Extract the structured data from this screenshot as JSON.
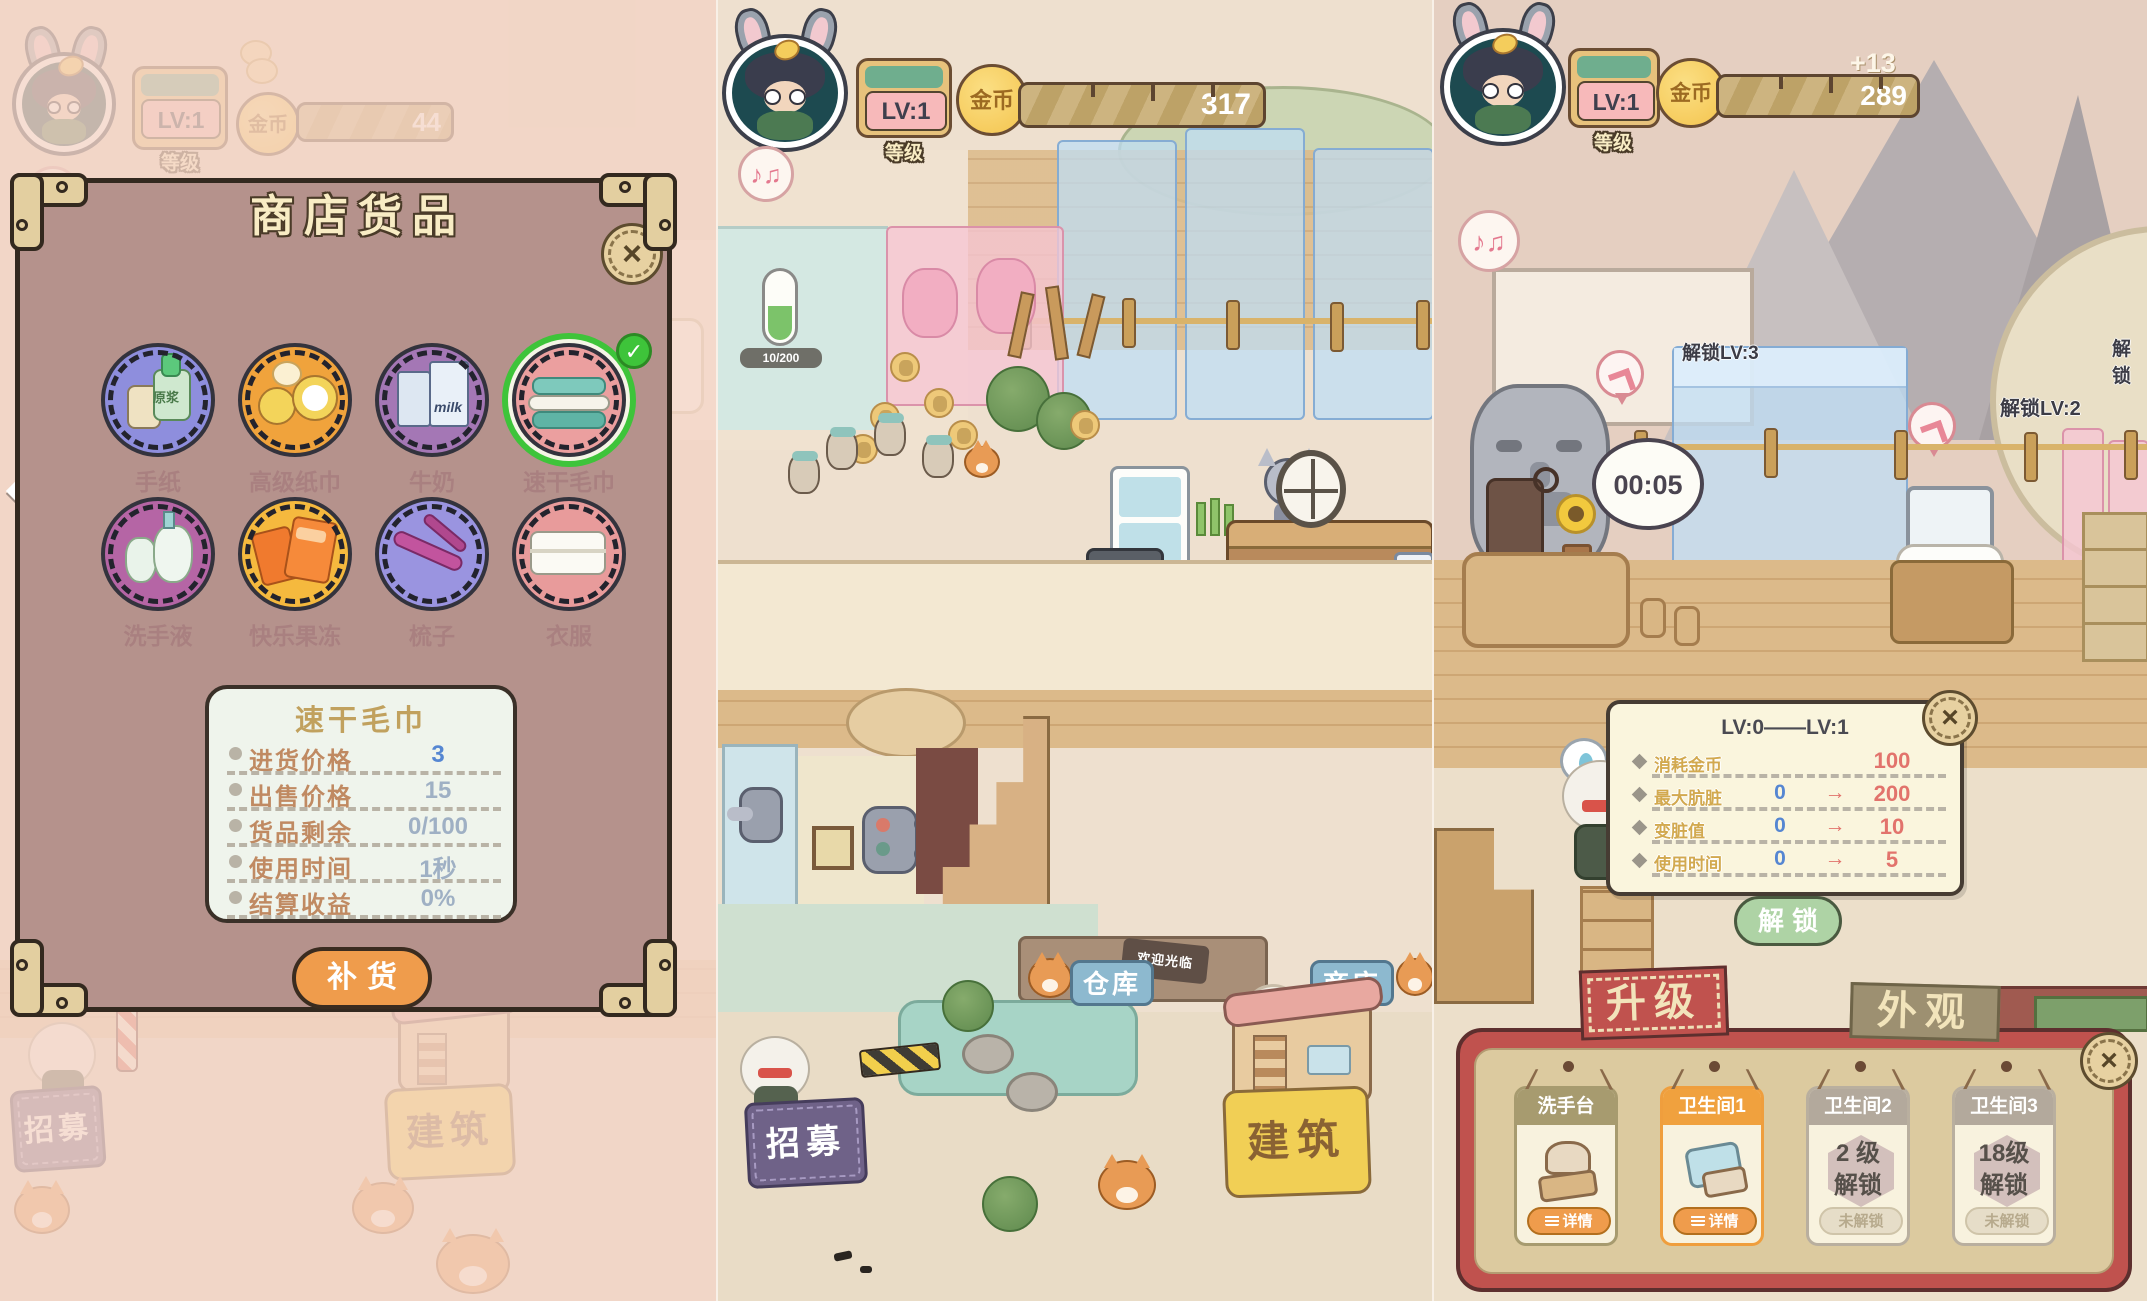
{
  "palette": {
    "accent-orange": "#ef9c4c",
    "accent-green": "#3ec43a",
    "btn-green": "#aed3a5",
    "tab-red": "#c0524e",
    "gold": "#f6c75b",
    "value-blue": "#5586d2",
    "value-red": "#e2736c",
    "sign-blue": "#8db9cf",
    "sign-purple": "#6f6288",
    "sign-yellow": "#f1cf55"
  },
  "panel1": {
    "topbar": {
      "lv": "LV:1",
      "level_label": "等级",
      "coin_label": "金币",
      "coins": "44"
    },
    "dialog": {
      "title": "商店货品",
      "close": "×",
      "check": "✓",
      "items": [
        {
          "label": "手纸",
          "icon_text": "原浆"
        },
        {
          "label": "高级纸巾"
        },
        {
          "label": "牛奶",
          "icon_text": "milk"
        },
        {
          "label": "速干毛巾",
          "selected": true
        },
        {
          "label": "洗手液"
        },
        {
          "label": "快乐果冻"
        },
        {
          "label": "梳子"
        },
        {
          "label": "衣服"
        }
      ],
      "detail": {
        "title": "速干毛巾",
        "stats": [
          {
            "label": "进货价格",
            "value": "3"
          },
          {
            "label": "出售价格",
            "value": "15"
          },
          {
            "label": "货品剩余",
            "value": "0/100"
          },
          {
            "label": "使用时间",
            "value": "1秒"
          },
          {
            "label": "结算收益",
            "value": "0%"
          }
        ]
      },
      "restock": "补货"
    },
    "bottom": {
      "recruit": "招募",
      "build": "建筑"
    }
  },
  "panel2": {
    "topbar": {
      "lv": "LV:1",
      "level_label": "等级",
      "coin_label": "金币",
      "coins": "317"
    },
    "scene": {
      "gauge": "10/200",
      "warehouse": "仓库",
      "shop": "商店",
      "welcome": "欢迎光临",
      "recruit": "招募",
      "build": "建筑"
    }
  },
  "panel3": {
    "topbar": {
      "lv": "LV:1",
      "level_label": "等级",
      "coin_label": "金币",
      "coins": "289",
      "coin_gain": "+13"
    },
    "scene": {
      "unlock_lv3": "解锁LV:3",
      "unlock_lv2": "解锁LV:2",
      "unlock_partial": "解锁",
      "timer": "00:05"
    },
    "upgrade": {
      "title": "LV:0——LV:1",
      "close": "×",
      "rows": [
        {
          "label": "消耗金币",
          "from": "",
          "arrow": "",
          "to": "100"
        },
        {
          "label": "最大肮脏",
          "from": "0",
          "arrow": "→",
          "to": "200"
        },
        {
          "label": "变脏值",
          "from": "0",
          "arrow": "→",
          "to": "10"
        },
        {
          "label": "使用时间",
          "from": "0",
          "arrow": "→",
          "to": "5"
        }
      ],
      "confirm": "解锁"
    },
    "sheet": {
      "tabs": [
        "升级",
        "外观"
      ],
      "close": "×",
      "cards": [
        {
          "title": "洗手台",
          "button": "详情"
        },
        {
          "title": "卫生间1",
          "button": "详情"
        },
        {
          "title": "卫生间2",
          "level": "2 级",
          "unlock": "解锁",
          "button": "未解锁"
        },
        {
          "title": "卫生间3",
          "level": "18级",
          "unlock": "解锁",
          "button": "未解锁"
        }
      ]
    }
  }
}
